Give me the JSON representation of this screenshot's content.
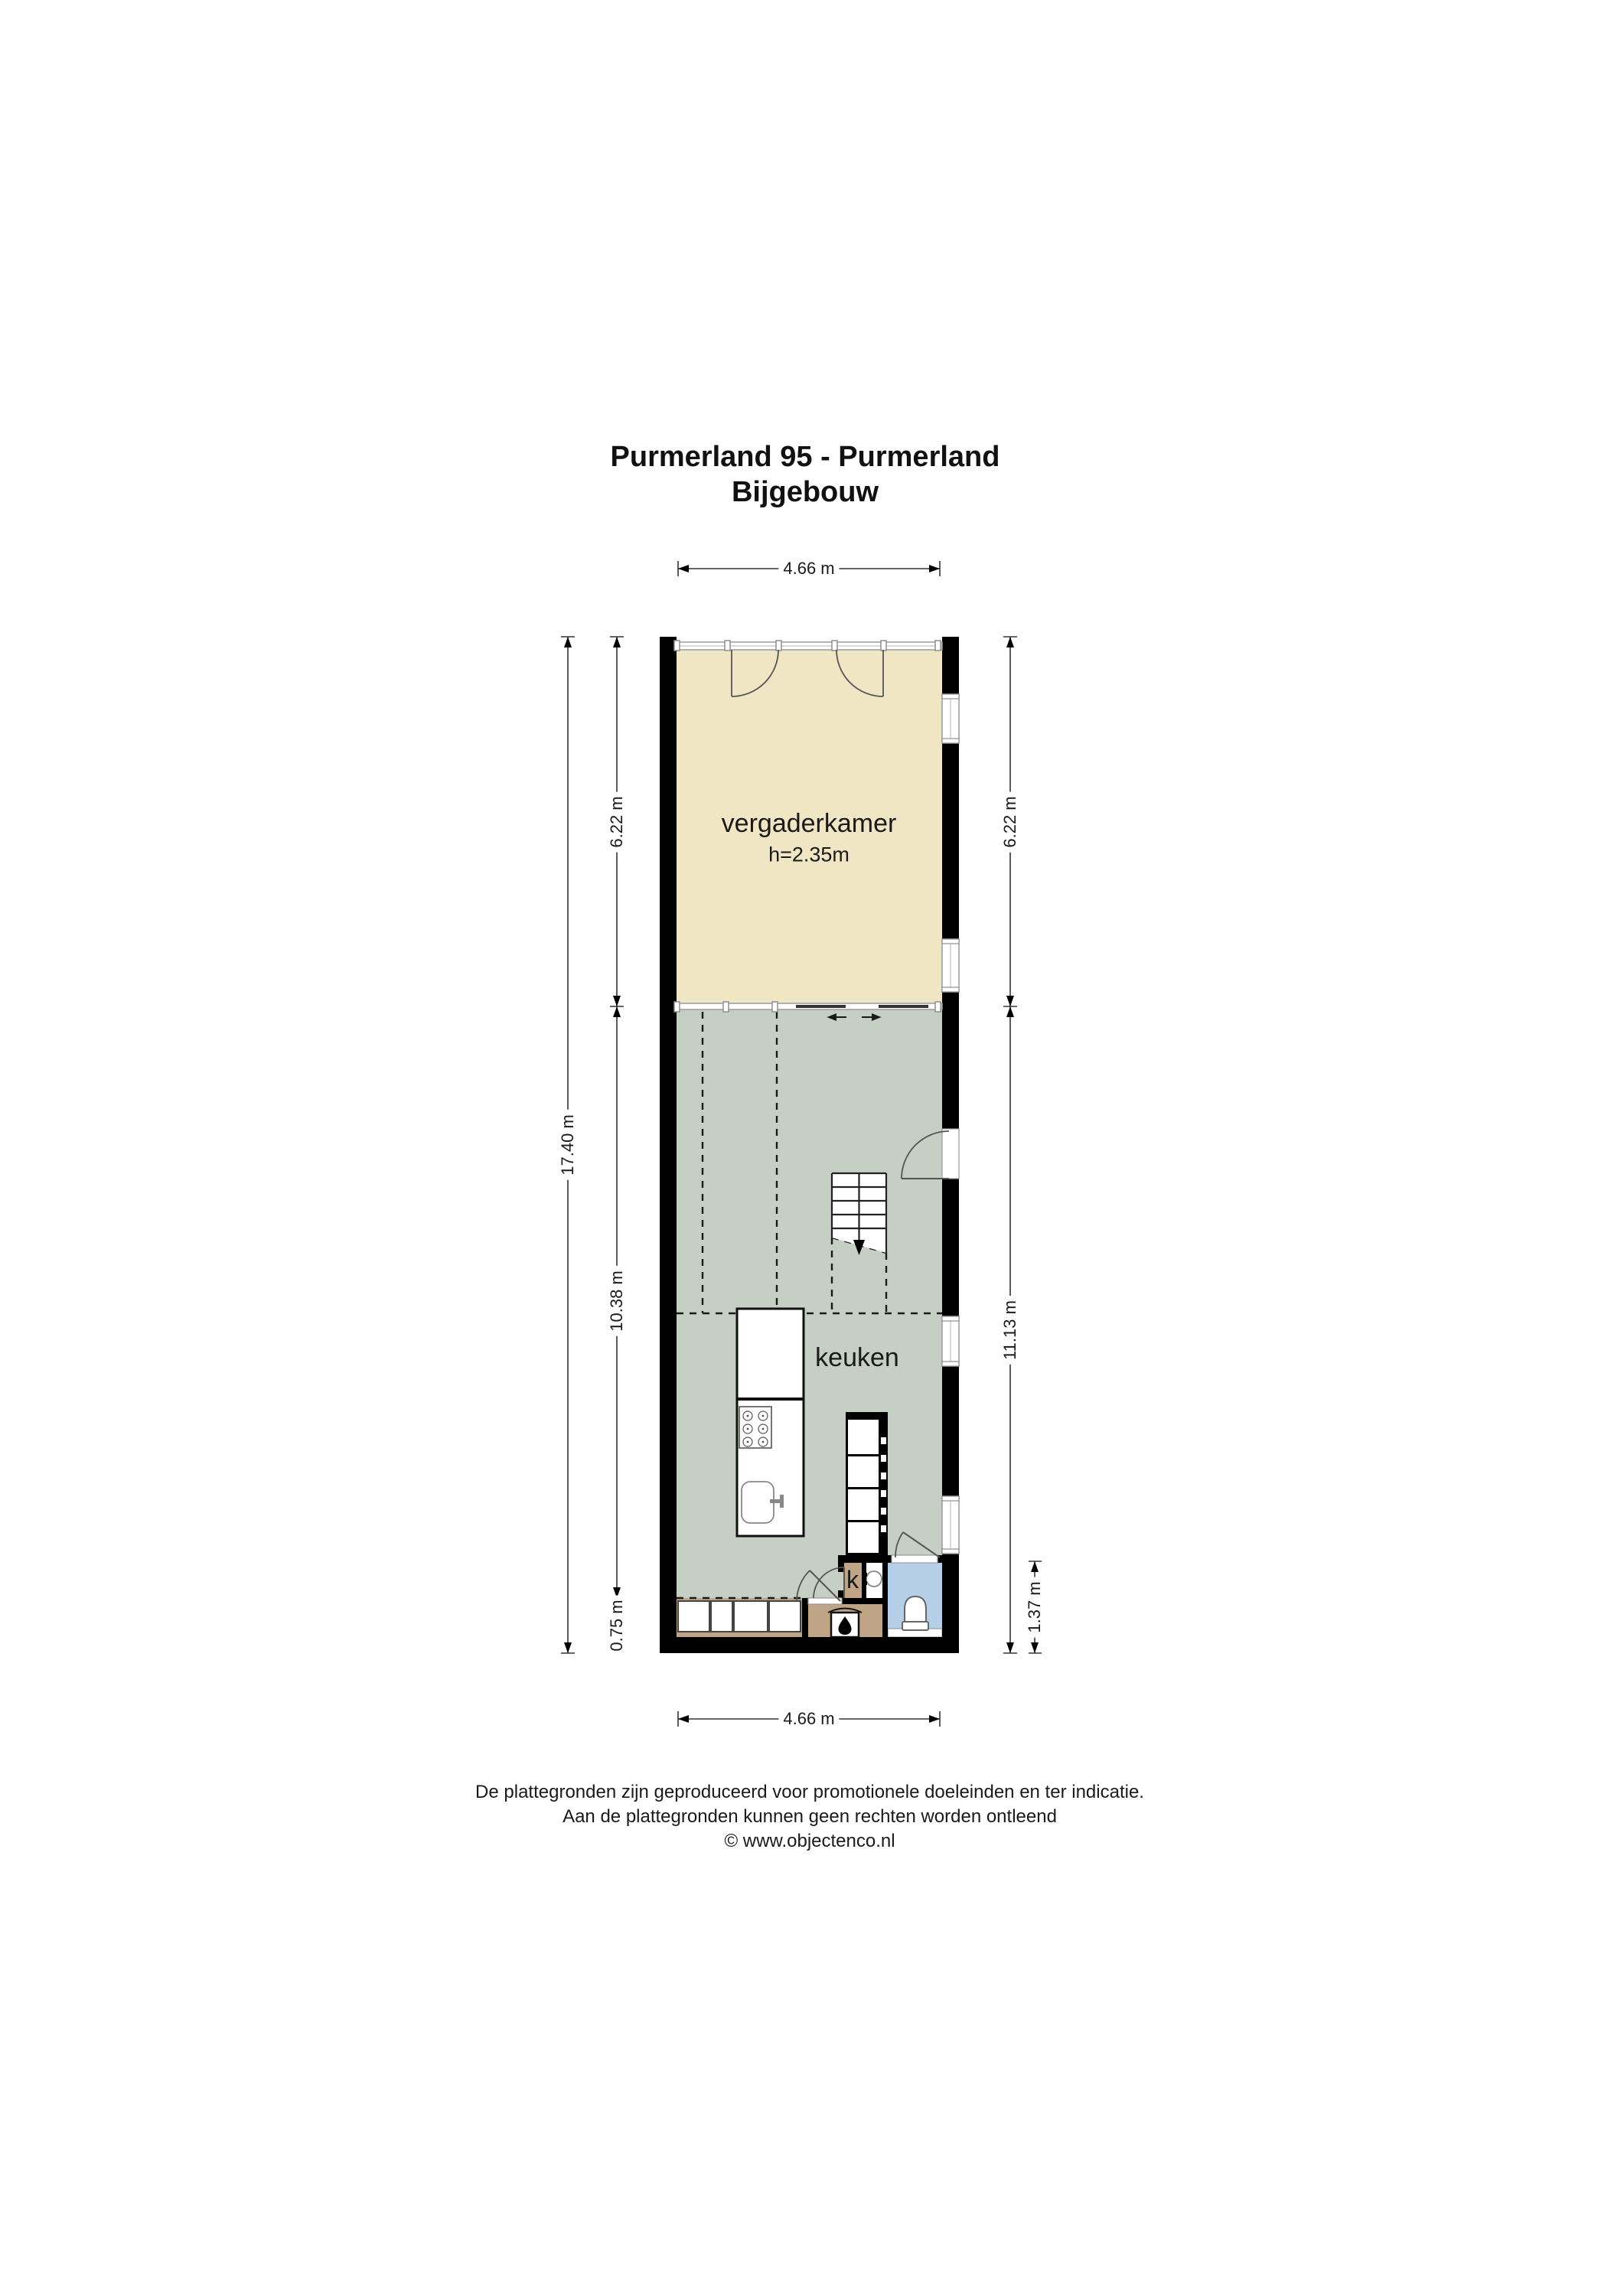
{
  "title": {
    "line1": "Purmerland 95 - Purmerland",
    "line2": "Bijgebouw"
  },
  "plan": {
    "rooms": {
      "vergaderkamer": {
        "label": "vergaderkamer",
        "ceiling_height": "h=2.35m"
      },
      "keuken": {
        "label": "keuken"
      },
      "closet": {
        "label": "k"
      }
    },
    "dimensions": {
      "top_width": "4.66 m",
      "bottom_width": "4.66 m",
      "left_total": "17.40 m",
      "left_top": "6.22 m",
      "left_middle": "10.38 m",
      "left_bottom": "0.75 m",
      "right_top": "6.22 m",
      "right_middle": "11.13 m",
      "right_bathroom": "1.37 m"
    },
    "colors": {
      "vergaderkamer_floor": "#f0e6c4",
      "living_floor": "#c5cfc3",
      "wood_floor": "#bfa485",
      "bathroom_floor": "#b5cfe8",
      "wall": "#000000"
    },
    "icons": {
      "fireplace": "flame-icon",
      "stairs_direction": "down-arrow-icon",
      "sliding_door": "left-right-arrows-icon"
    }
  },
  "footer": {
    "line1": "De plattegronden zijn geproduceerd voor promotionele doeleinden en ter indicatie.",
    "line2": "Aan de plattegronden kunnen geen rechten worden ontleend",
    "line3": "© www.objectenco.nl"
  }
}
